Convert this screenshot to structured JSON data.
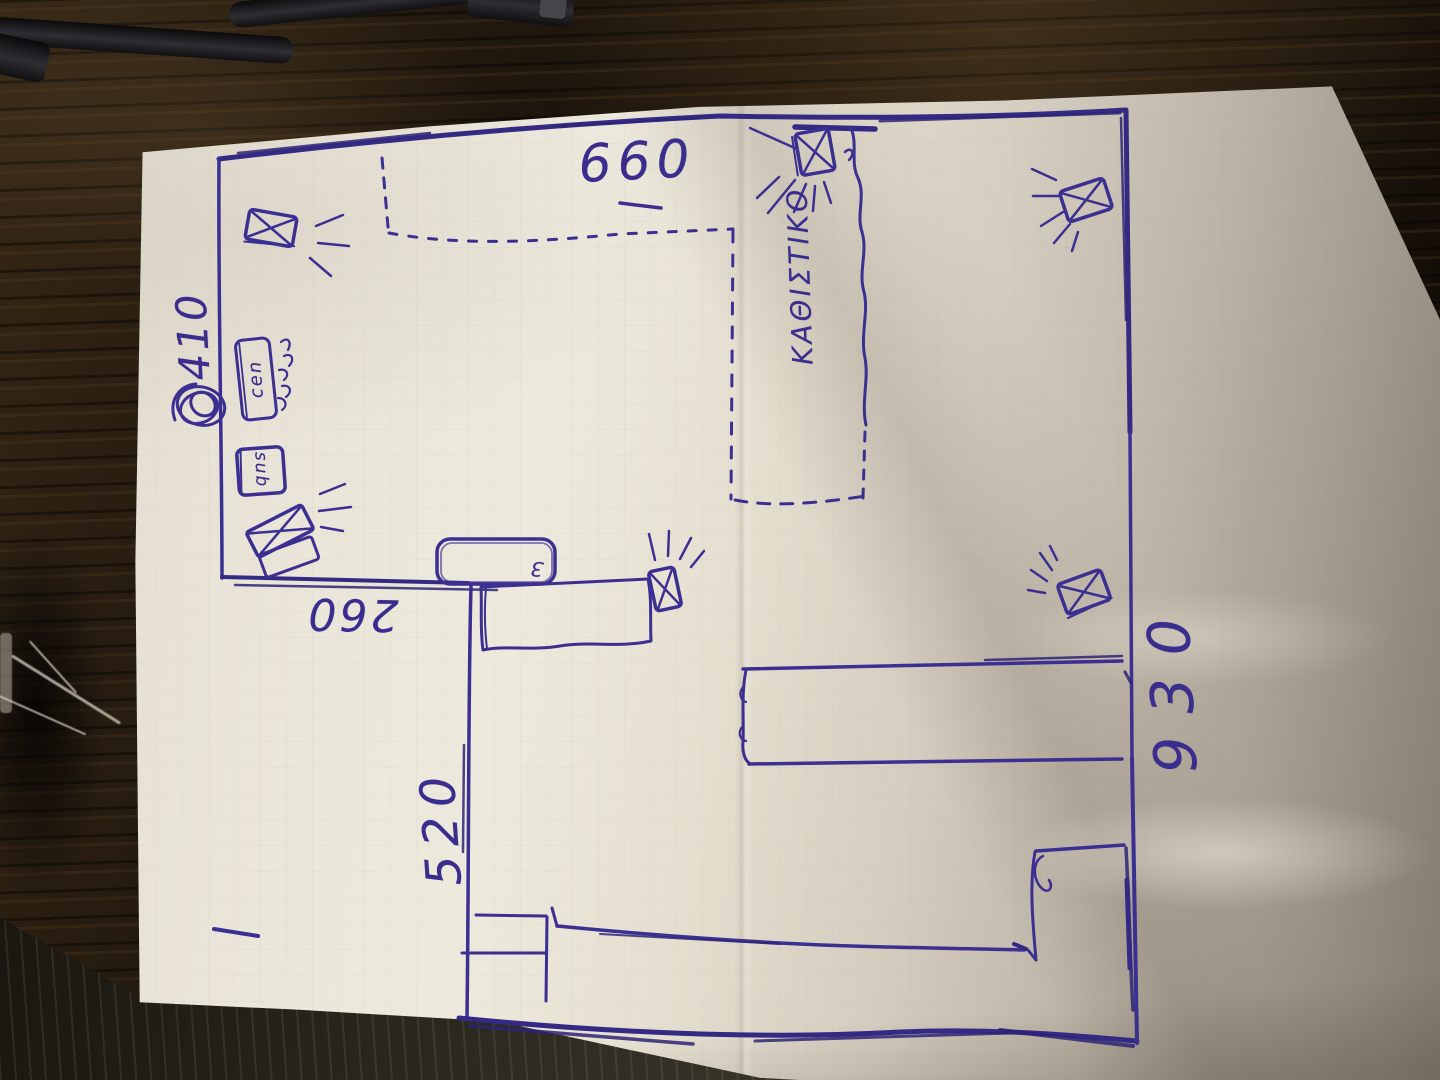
{
  "sketch": {
    "dimensions": {
      "top": "660",
      "left": "410",
      "middle": "260",
      "lower_left": "520",
      "right": "930"
    },
    "labels": {
      "room": "ΚΑΘΙΣΤΙΚΟ",
      "center_speaker": "cen",
      "subwoofer": "sub",
      "cabinet_mark": "3"
    },
    "colors": {
      "ink": "#3c2f92",
      "paper": "#e8e3d6",
      "wood": "#261b10"
    },
    "icons": {
      "speaker": "crossed-box-speaker-icon",
      "sound_waves": "sound-wave-rays",
      "cable_coil": "cable-coil-scribble"
    }
  }
}
